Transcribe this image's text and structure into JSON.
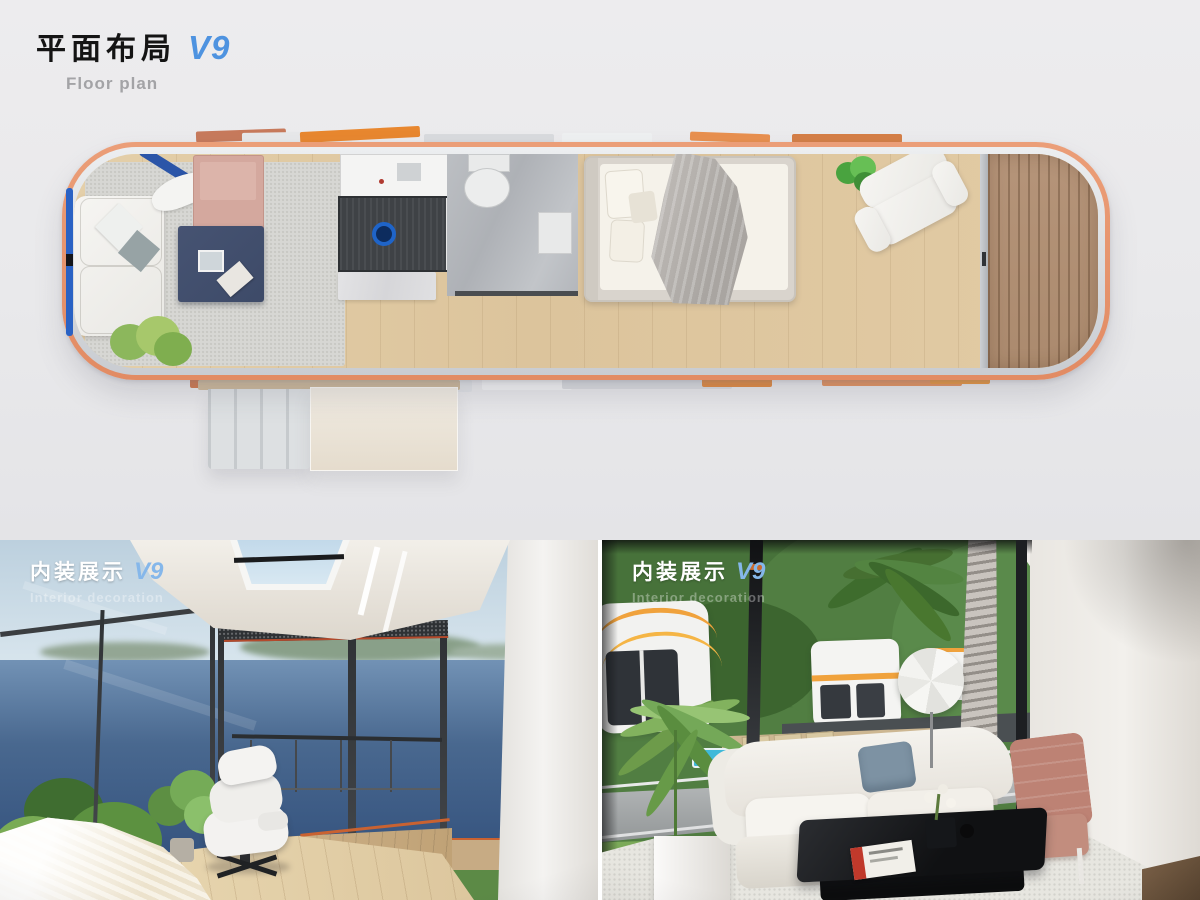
{
  "palette": {
    "background_gray": "#e9e9eb",
    "title_black": "#141414",
    "version_blue": "#4e93e0",
    "subtitle_gray": "#a3a3a6",
    "overlay_version_blue": "#85b7ea",
    "capsule_rim_orange": "#e39067",
    "module_orange": "#e8872f",
    "wood_floor_tan": "#ddc49e",
    "deck_wood_brown": "#b29176",
    "navy_coffee_table": "#3e4b69",
    "blush_ottoman": "#d4a89e",
    "ocean_blue": "#32527f",
    "hill_green": "#4e7a3e",
    "terracotta_chair": "#bd8274",
    "sofa_white": "#f2efe9"
  },
  "floor_plan": {
    "title_zh": "平面布局",
    "version": "V9",
    "subtitle_en": "Floor plan"
  },
  "interior_left": {
    "title_zh": "内装展示",
    "version": "V9",
    "subtitle_en": "Interior decoration"
  },
  "interior_right": {
    "title_zh": "内装展示",
    "version": "V9",
    "subtitle_en": "Interior decoration"
  }
}
